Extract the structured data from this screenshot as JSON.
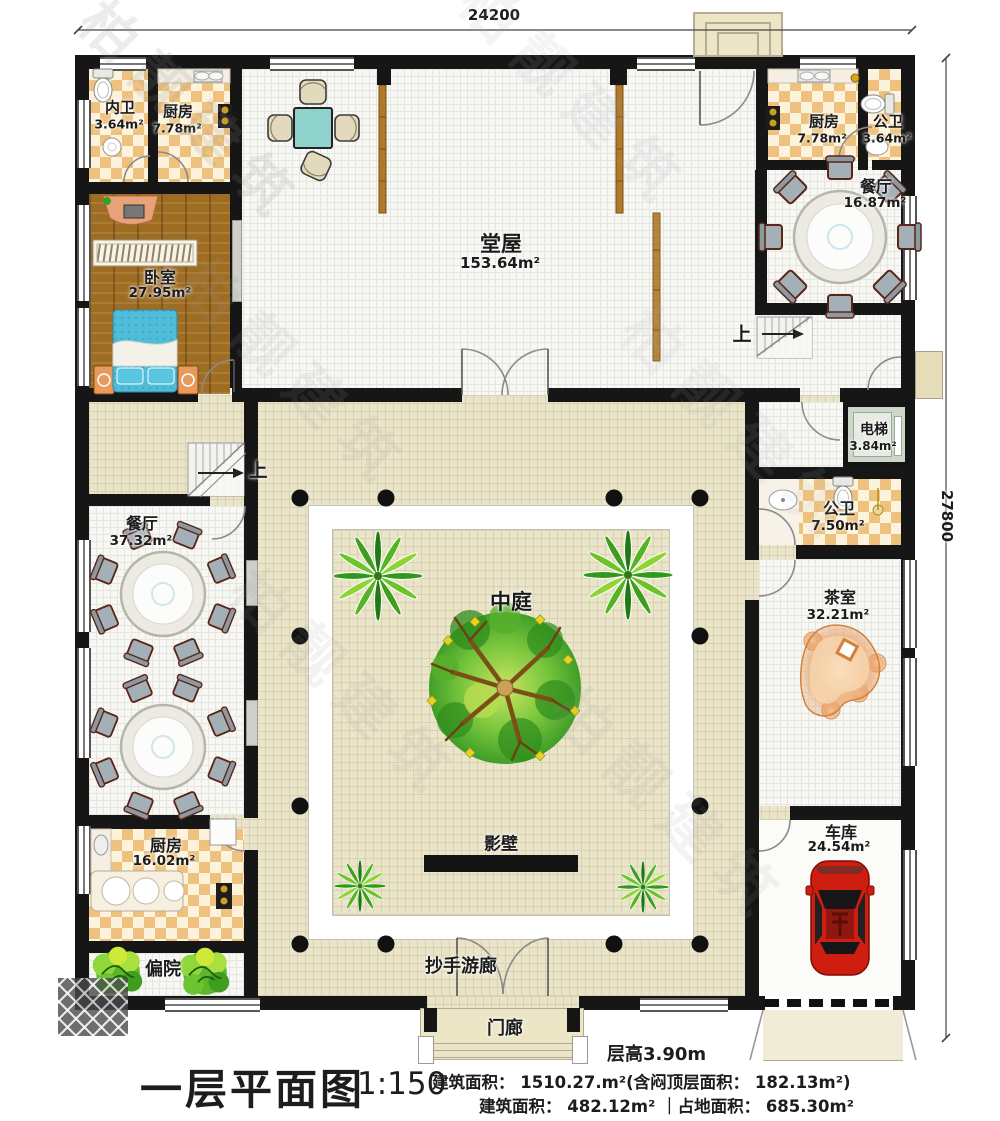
{
  "dims": {
    "top": "24200",
    "right": "27800"
  },
  "rooms": {
    "neiwei": {
      "name": "内卫",
      "area": "3.64m²"
    },
    "kitchen_tl": {
      "name": "厨房",
      "area": "7.78m²"
    },
    "hall": {
      "name": "堂屋",
      "area": "153.64m²"
    },
    "kitchen_tr": {
      "name": "厨房",
      "area": "7.78m²"
    },
    "bath_tr": {
      "name": "公卫",
      "area": "3.64m²"
    },
    "dining_tr": {
      "name": "餐厅",
      "area": "16.87m²"
    },
    "bedroom": {
      "name": "卧室",
      "area": "27.95m²"
    },
    "elevator": {
      "name": "电梯",
      "area": "3.84m²"
    },
    "bath_r": {
      "name": "公卫",
      "area": "7.50m²"
    },
    "dining_l": {
      "name": "餐厅",
      "area": "37.32m²"
    },
    "courtyard": {
      "name": "中庭"
    },
    "tearoom": {
      "name": "茶室",
      "area": "32.21m²"
    },
    "kitchen_bl": {
      "name": "厨房",
      "area": "16.02m²"
    },
    "yingbi": {
      "name": "影壁"
    },
    "sideyard": {
      "name": "偏院"
    },
    "corridor": {
      "name": "抄手游廊"
    },
    "porch": {
      "name": "门廊"
    },
    "garage": {
      "name": "车库",
      "area": "24.54m²"
    },
    "stairs": {
      "up": "上"
    }
  },
  "titleblock": {
    "title": "一层平面图",
    "scale": "1:150",
    "floor_height": "层高3.90m",
    "area_line1": "建筑面积： 1510.27.m²(含闷顶层面积： 182.13m²)",
    "area_line2": "建筑面积： 482.12m²  ｜占地面积： 685.30m²"
  },
  "watermark": {
    "text": "柏靓建筑"
  },
  "colors": {
    "wall": "#161616",
    "courtyard_beige": "#eae4c8",
    "checker": "#eec27e",
    "wood_floor": "#9e6d24",
    "bed_blue": "#4fbcd9",
    "car_red": "#cf1d10",
    "tree_green": "#4aa821",
    "elevator_gray": "#ccd6c9"
  }
}
